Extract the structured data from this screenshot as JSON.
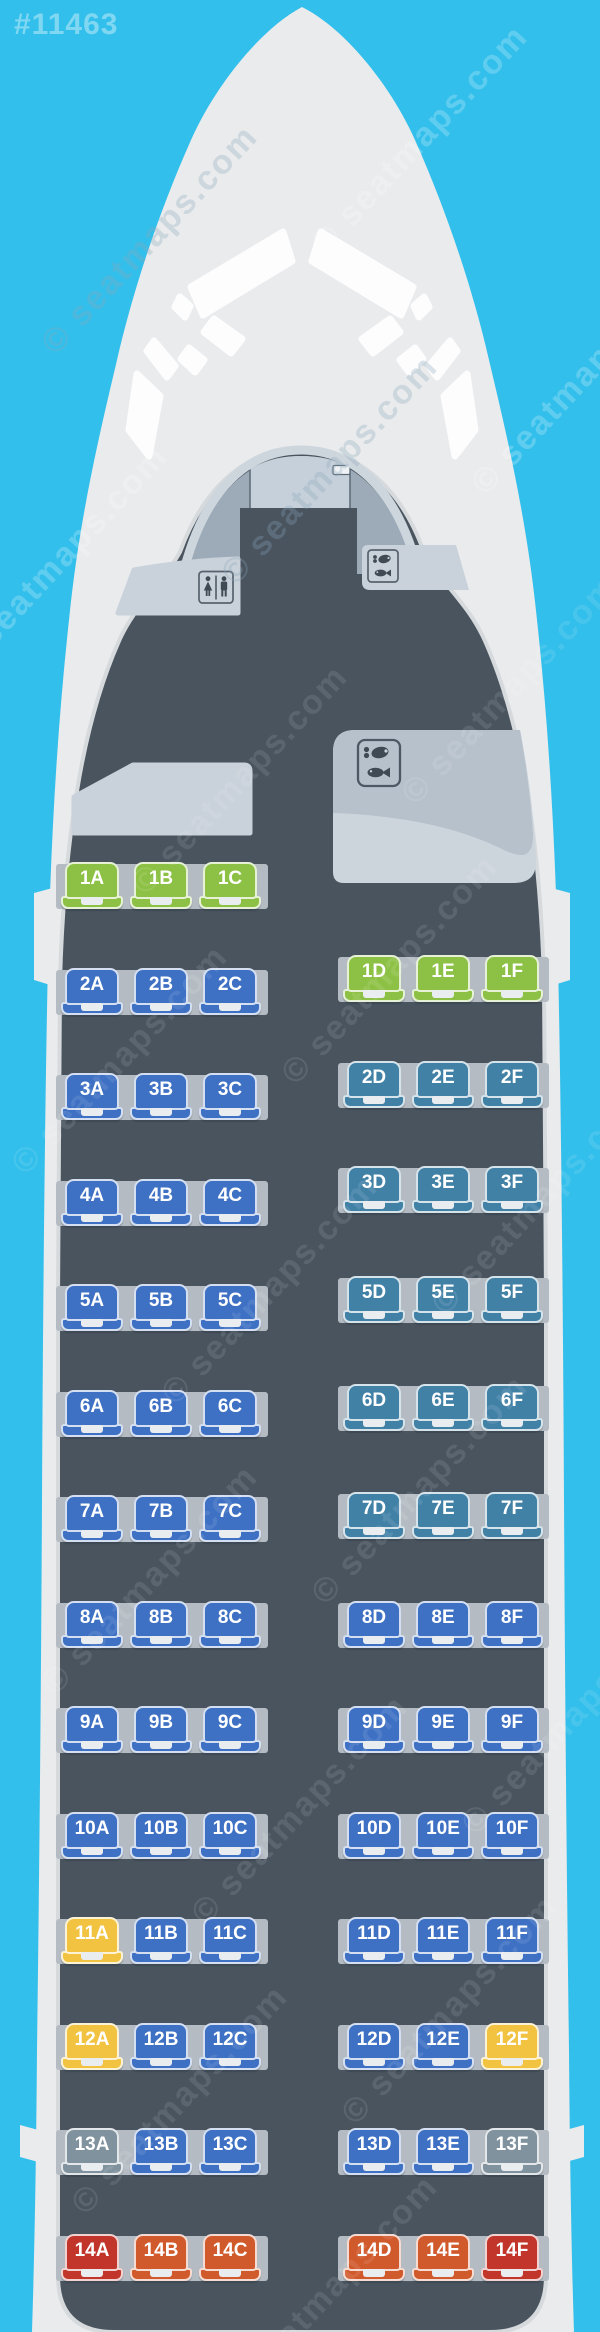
{
  "map_id": "#11463",
  "watermark_text": "© seatmaps.com",
  "colors": {
    "sky": "#33bfeb",
    "fuselage": "#e9ebed",
    "cabin_floor": "#49545f",
    "monument": "#c9d1da",
    "rail": "#b4bbc2",
    "seat_green": "#8dc145",
    "seat_blue": "#3e70c3",
    "seat_teal": "#4181a6",
    "seat_yellow": "#f2c341",
    "seat_gray": "#7f929d",
    "seat_red": "#c1352a",
    "seat_orange": "#d15a2d"
  },
  "facilities": [
    {
      "type": "lavatory",
      "icon": "lavatory-icon",
      "position": "front-left"
    },
    {
      "type": "galley",
      "icon": "meal-icon",
      "position": "front-right"
    },
    {
      "type": "closet",
      "icon": "none",
      "position": "mid-left"
    },
    {
      "type": "galley",
      "icon": "meal-icon",
      "position": "mid-right"
    }
  ],
  "cabin": {
    "rows": [
      {
        "row": "1",
        "left": [
          {
            "id": "1A",
            "color": "seat_green"
          },
          {
            "id": "1B",
            "color": "seat_green"
          },
          {
            "id": "1C",
            "color": "seat_green"
          }
        ],
        "right": [
          {
            "id": "1D",
            "color": "seat_green"
          },
          {
            "id": "1E",
            "color": "seat_green"
          },
          {
            "id": "1F",
            "color": "seat_green"
          }
        ]
      },
      {
        "row": "2",
        "left": [
          {
            "id": "2A",
            "color": "seat_blue"
          },
          {
            "id": "2B",
            "color": "seat_blue"
          },
          {
            "id": "2C",
            "color": "seat_blue"
          }
        ],
        "right": [
          {
            "id": "2D",
            "color": "seat_teal"
          },
          {
            "id": "2E",
            "color": "seat_teal"
          },
          {
            "id": "2F",
            "color": "seat_teal"
          }
        ]
      },
      {
        "row": "3",
        "left": [
          {
            "id": "3A",
            "color": "seat_blue"
          },
          {
            "id": "3B",
            "color": "seat_blue"
          },
          {
            "id": "3C",
            "color": "seat_blue"
          }
        ],
        "right": [
          {
            "id": "3D",
            "color": "seat_teal"
          },
          {
            "id": "3E",
            "color": "seat_teal"
          },
          {
            "id": "3F",
            "color": "seat_teal"
          }
        ]
      },
      {
        "row": "4",
        "left": [
          {
            "id": "4A",
            "color": "seat_blue"
          },
          {
            "id": "4B",
            "color": "seat_blue"
          },
          {
            "id": "4C",
            "color": "seat_blue"
          }
        ],
        "right": []
      },
      {
        "row": "5",
        "left": [
          {
            "id": "5A",
            "color": "seat_blue"
          },
          {
            "id": "5B",
            "color": "seat_blue"
          },
          {
            "id": "5C",
            "color": "seat_blue"
          }
        ],
        "right": [
          {
            "id": "5D",
            "color": "seat_teal"
          },
          {
            "id": "5E",
            "color": "seat_teal"
          },
          {
            "id": "5F",
            "color": "seat_teal"
          }
        ]
      },
      {
        "row": "6",
        "left": [
          {
            "id": "6A",
            "color": "seat_blue"
          },
          {
            "id": "6B",
            "color": "seat_blue"
          },
          {
            "id": "6C",
            "color": "seat_blue"
          }
        ],
        "right": [
          {
            "id": "6D",
            "color": "seat_teal"
          },
          {
            "id": "6E",
            "color": "seat_teal"
          },
          {
            "id": "6F",
            "color": "seat_teal"
          }
        ]
      },
      {
        "row": "7",
        "left": [
          {
            "id": "7A",
            "color": "seat_blue"
          },
          {
            "id": "7B",
            "color": "seat_blue"
          },
          {
            "id": "7C",
            "color": "seat_blue"
          }
        ],
        "right": [
          {
            "id": "7D",
            "color": "seat_teal"
          },
          {
            "id": "7E",
            "color": "seat_teal"
          },
          {
            "id": "7F",
            "color": "seat_teal"
          }
        ]
      },
      {
        "row": "8",
        "left": [
          {
            "id": "8A",
            "color": "seat_blue"
          },
          {
            "id": "8B",
            "color": "seat_blue"
          },
          {
            "id": "8C",
            "color": "seat_blue"
          }
        ],
        "right": [
          {
            "id": "8D",
            "color": "seat_blue"
          },
          {
            "id": "8E",
            "color": "seat_blue"
          },
          {
            "id": "8F",
            "color": "seat_blue"
          }
        ]
      },
      {
        "row": "9",
        "left": [
          {
            "id": "9A",
            "color": "seat_blue"
          },
          {
            "id": "9B",
            "color": "seat_blue"
          },
          {
            "id": "9C",
            "color": "seat_blue"
          }
        ],
        "right": [
          {
            "id": "9D",
            "color": "seat_blue"
          },
          {
            "id": "9E",
            "color": "seat_blue"
          },
          {
            "id": "9F",
            "color": "seat_blue"
          }
        ]
      },
      {
        "row": "10",
        "left": [
          {
            "id": "10A",
            "color": "seat_blue"
          },
          {
            "id": "10B",
            "color": "seat_blue"
          },
          {
            "id": "10C",
            "color": "seat_blue"
          }
        ],
        "right": [
          {
            "id": "10D",
            "color": "seat_blue"
          },
          {
            "id": "10E",
            "color": "seat_blue"
          },
          {
            "id": "10F",
            "color": "seat_blue"
          }
        ]
      },
      {
        "row": "11",
        "left": [
          {
            "id": "11A",
            "color": "seat_yellow"
          },
          {
            "id": "11B",
            "color": "seat_blue"
          },
          {
            "id": "11C",
            "color": "seat_blue"
          }
        ],
        "right": [
          {
            "id": "11D",
            "color": "seat_blue"
          },
          {
            "id": "11E",
            "color": "seat_blue"
          },
          {
            "id": "11F",
            "color": "seat_blue"
          }
        ]
      },
      {
        "row": "12",
        "left": [
          {
            "id": "12A",
            "color": "seat_yellow"
          },
          {
            "id": "12B",
            "color": "seat_blue"
          },
          {
            "id": "12C",
            "color": "seat_blue"
          }
        ],
        "right": [
          {
            "id": "12D",
            "color": "seat_blue"
          },
          {
            "id": "12E",
            "color": "seat_blue"
          },
          {
            "id": "12F",
            "color": "seat_yellow"
          }
        ]
      },
      {
        "row": "13",
        "left": [
          {
            "id": "13A",
            "color": "seat_gray"
          },
          {
            "id": "13B",
            "color": "seat_blue"
          },
          {
            "id": "13C",
            "color": "seat_blue"
          }
        ],
        "right": [
          {
            "id": "13D",
            "color": "seat_blue"
          },
          {
            "id": "13E",
            "color": "seat_blue"
          },
          {
            "id": "13F",
            "color": "seat_gray"
          }
        ]
      },
      {
        "row": "14",
        "left": [
          {
            "id": "14A",
            "color": "seat_red"
          },
          {
            "id": "14B",
            "color": "seat_orange"
          },
          {
            "id": "14C",
            "color": "seat_orange"
          }
        ],
        "right": [
          {
            "id": "14D",
            "color": "seat_orange"
          },
          {
            "id": "14E",
            "color": "seat_orange"
          },
          {
            "id": "14F",
            "color": "seat_red"
          }
        ]
      }
    ]
  }
}
